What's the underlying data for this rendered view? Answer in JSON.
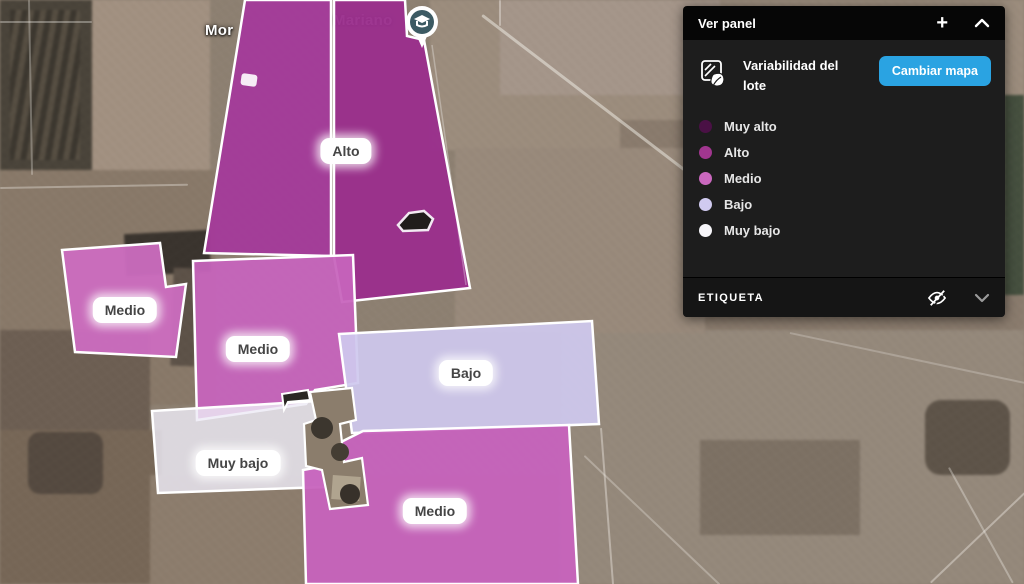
{
  "map": {
    "place_labels": [
      {
        "text": "Mor"
      },
      {
        "text": "Mariano"
      }
    ],
    "zone_chips": [
      {
        "label": "Alto"
      },
      {
        "label": "Medio"
      },
      {
        "label": "Medio"
      },
      {
        "label": "Bajo"
      },
      {
        "label": "Muy bajo"
      },
      {
        "label": "Medio"
      }
    ],
    "zone_colors": {
      "alto": "#9a2f8c",
      "alto_left": "#a43a9a",
      "medio_left": "#cd6cc0",
      "medio_center": "#c764bc",
      "bajo": "#cfc8ee",
      "muy_bajo": "#edeaf5",
      "medio_bottom": "#c763bd"
    }
  },
  "panel": {
    "title": "Ver panel",
    "add_button": "+",
    "layer_name": "Variabilidad del lote",
    "change_map_button": "Cambiar mapa",
    "button_color": "#2aa3e2",
    "legend": [
      {
        "label": "Muy alto",
        "color": "#4a1145"
      },
      {
        "label": "Alto",
        "color": "#a1368f"
      },
      {
        "label": "Medio",
        "color": "#ca68be"
      },
      {
        "label": "Bajo",
        "color": "#d0caf0"
      },
      {
        "label": "Muy bajo",
        "color": "#f6f5f9"
      }
    ],
    "etiqueta_label": "ETIQUETA"
  }
}
